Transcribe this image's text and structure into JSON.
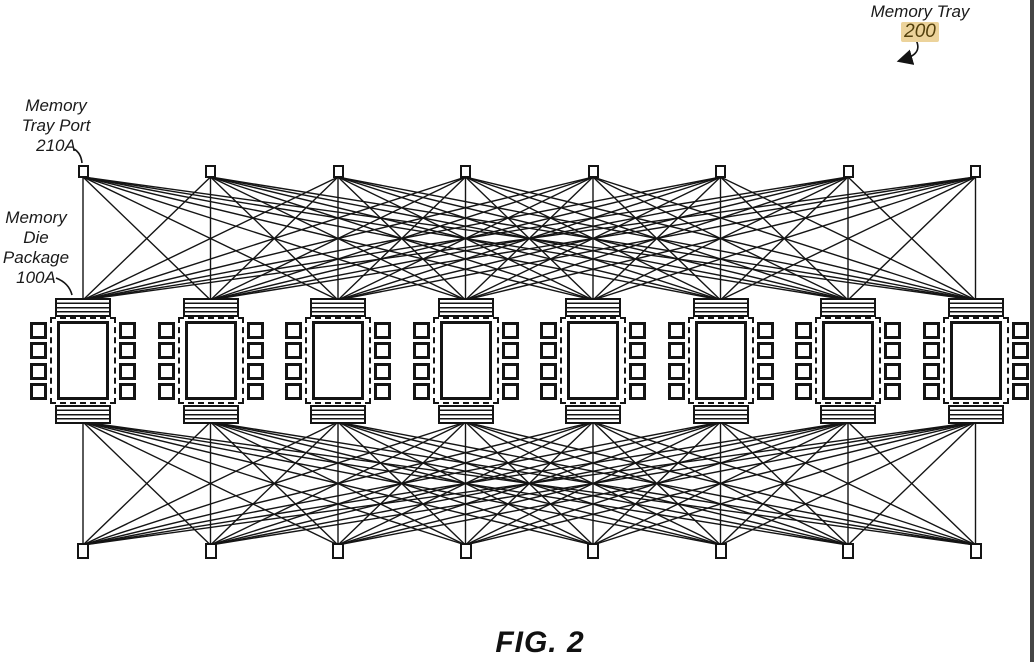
{
  "figure": {
    "caption": "FIG. 2",
    "memory_tray": {
      "title": "Memory Tray",
      "ref": "200"
    },
    "memory_tray_port": {
      "line1": "Memory",
      "line2": "Tray Port",
      "ref": "210A"
    },
    "memory_die_package": {
      "line1": "Memory",
      "line2": "Die",
      "line3": "Package",
      "ref": "100A"
    },
    "counts": {
      "top_ports": 8,
      "packages": 8,
      "bottom_ports": 8,
      "pins_per_package_side": 4
    },
    "colors": {
      "ink": "#141414",
      "ref_highlight_bg": "#ecd39b",
      "ref_highlight_text": "#53400c",
      "scan_border": "#454545"
    }
  }
}
